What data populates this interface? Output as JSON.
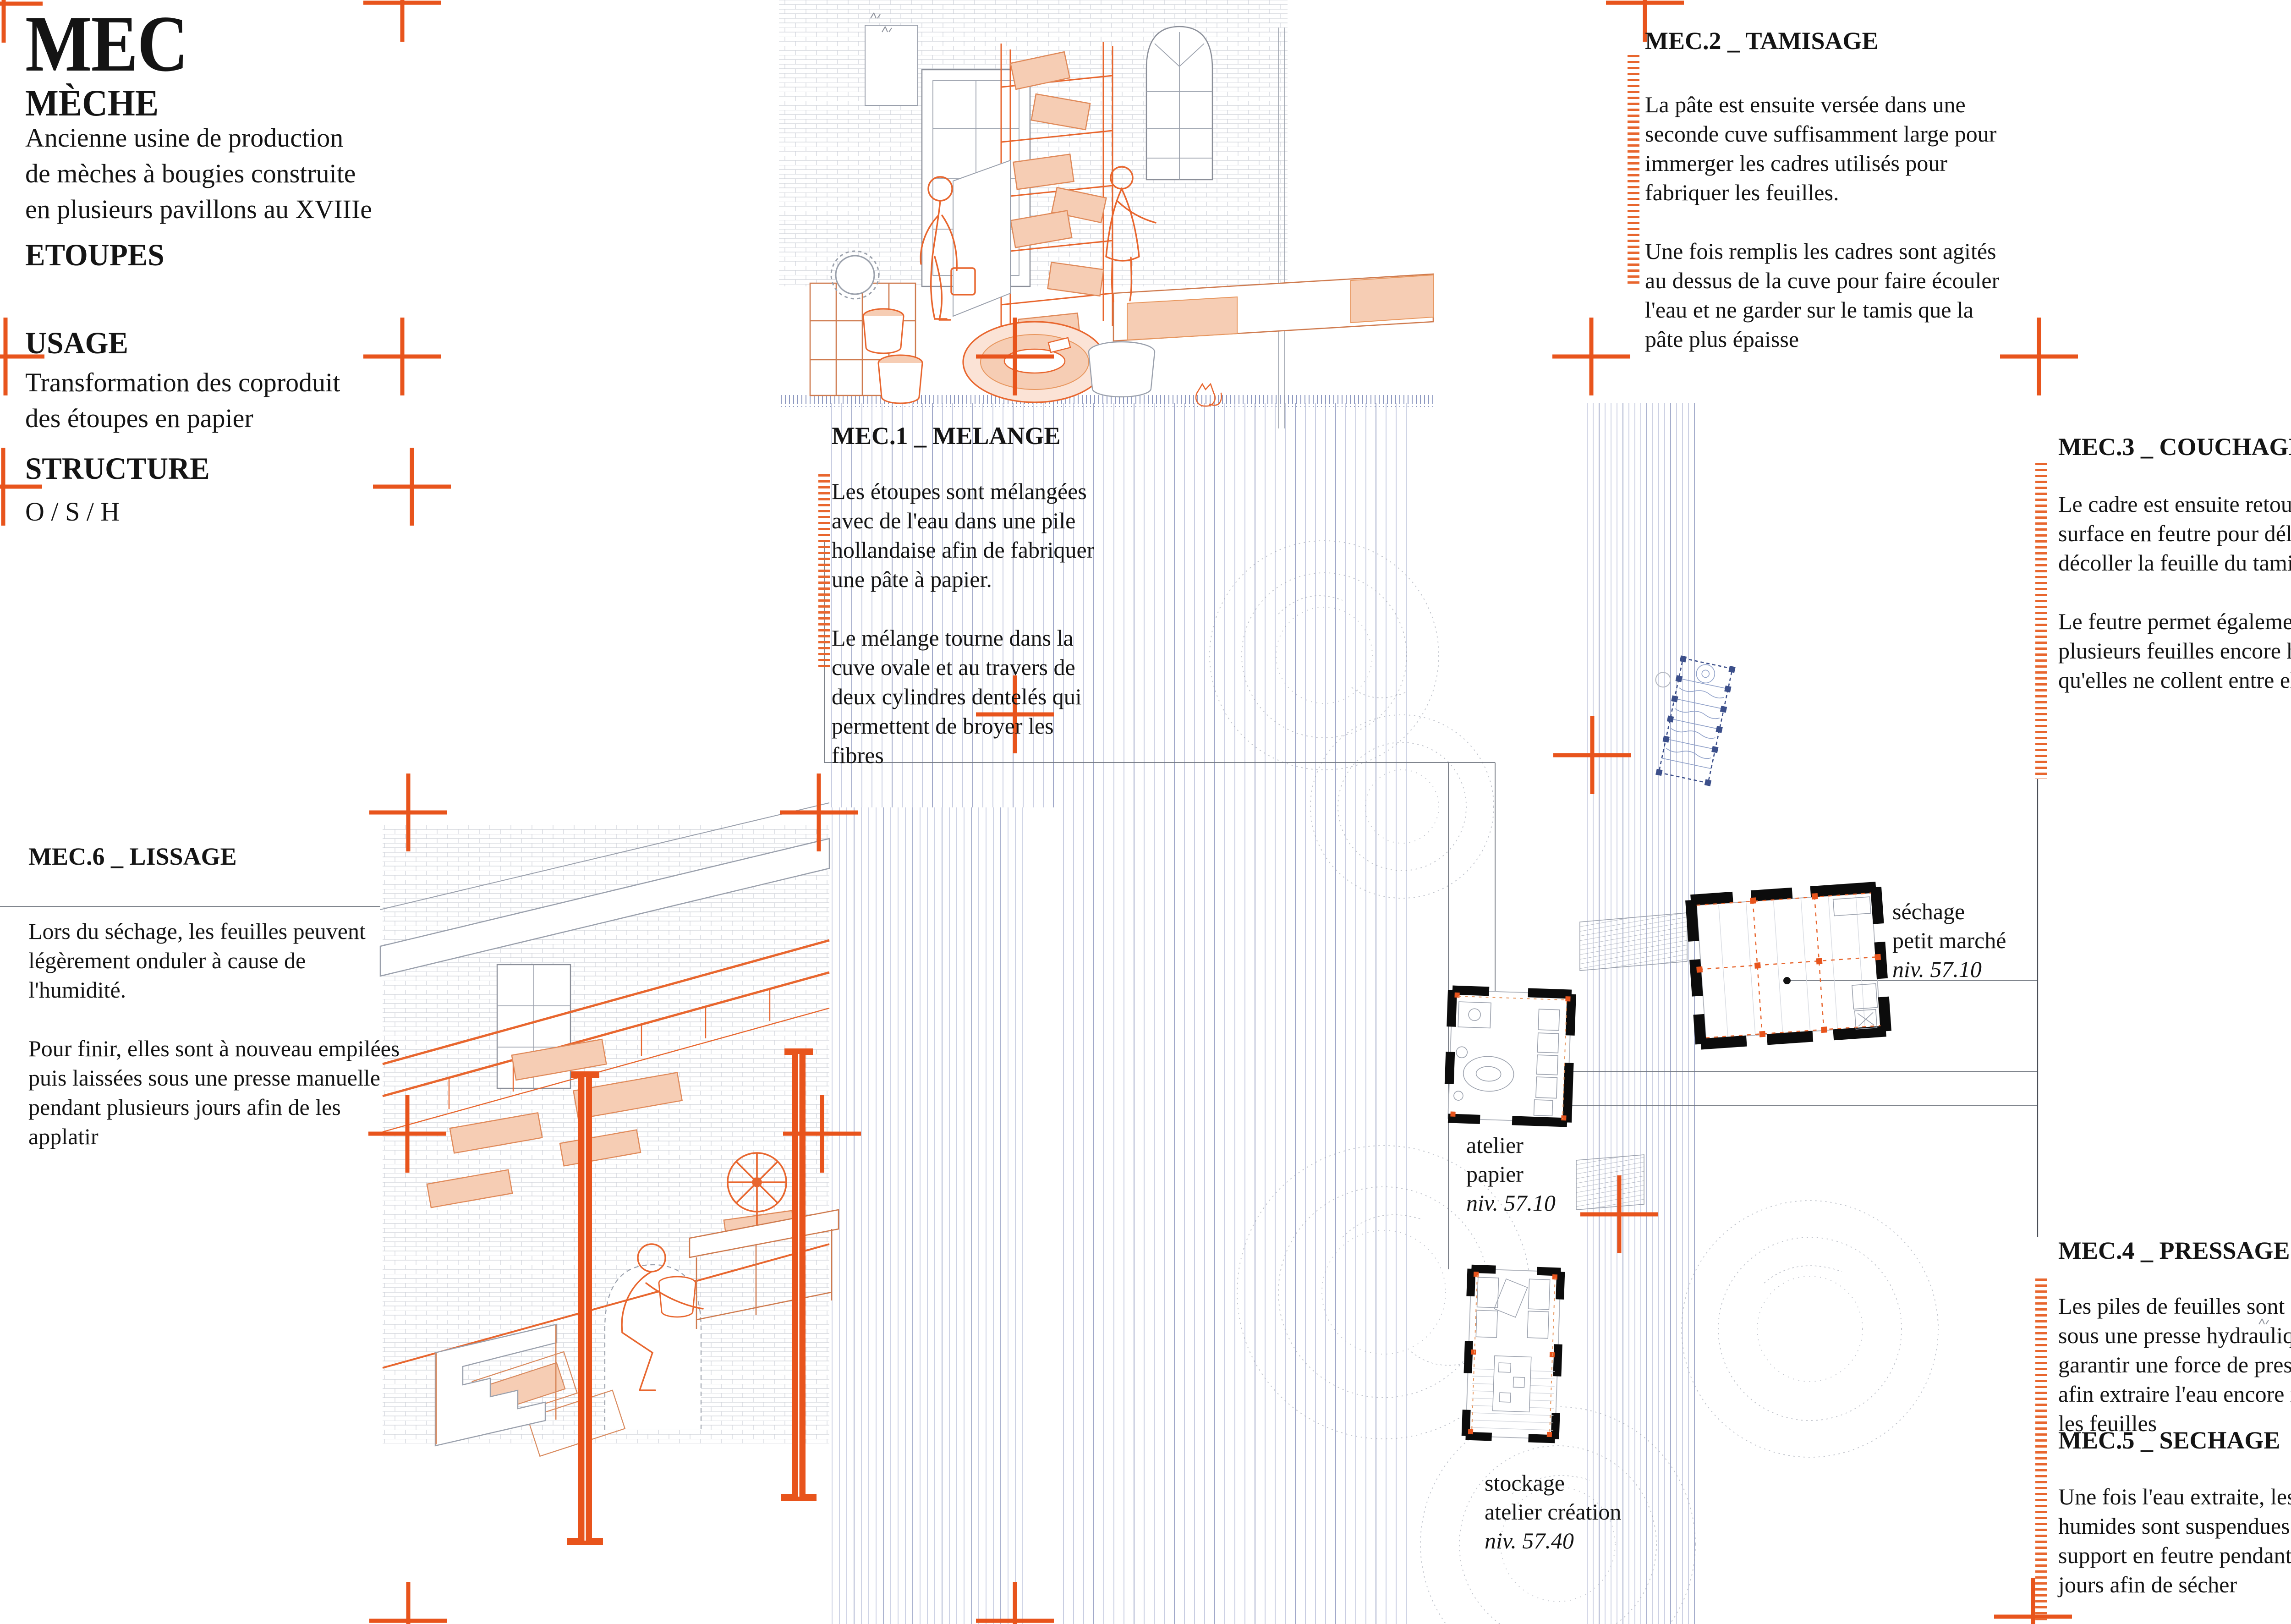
{
  "title_block": {
    "acronym": "MEC",
    "name": "MÈCHE",
    "description": "Ancienne usine de production\nde mèches à bougies construite\nen plusieurs pavillons au XVIIIe",
    "material_label": "ETOUPES",
    "usage_label": "USAGE",
    "usage_text": "Transformation des coproduit\ndes étoupes en papier",
    "structure_label": "STRUCTURE",
    "structure_value": "O / S / H"
  },
  "steps": [
    {
      "id": "MEC.1",
      "title": "MEC.1 _ MELANGE",
      "body": "Les étoupes sont mélangées\navec de l'eau dans une pile\nhollandaise afin de fabriquer\nune pâte à papier.\n\nLe mélange tourne dans la\ncuve ovale et au travers de\ndeux cylindres dentelés qui\npermettent de broyer les\nfibres"
    },
    {
      "id": "MEC.2",
      "title": "MEC.2 _ TAMISAGE",
      "body": "La pâte est ensuite versée dans une\nseconde cuve suffisamment large pour\nimmerger les cadres utilisés pour\nfabriquer les feuilles.\n\nUne fois remplis les cadres sont agités\nau dessus de la cuve pour faire écouler\nl'eau et ne garder sur le tamis que la\npâte plus épaisse"
    },
    {
      "id": "MEC.3",
      "title": "MEC.3 _ COUCHAGE",
      "body": "Le cadre est ensuite retourner sur un\nsurface en feutre pour délicatement\ndécoller la feuille du tamis.\n\nLe feutre permet également d'empiler\nplusieurs feuilles encore humides sans\nqu'elles ne collent entre elles"
    },
    {
      "id": "MEC.4",
      "title": "MEC.4 _ PRESSAGE",
      "body": "Les piles de feuilles sont ensuite mises\nsous une presse hydraulique pour\ngarantir une force de presse suffisante\nafin extraire l'eau encore imbibée dans\nles feuilles"
    },
    {
      "id": "MEC.5",
      "title": "MEC.5 _ SECHAGE",
      "body": "Une fois l'eau extraite, les feuilles\nhumides sont suspendues par leur\nsupport en feutre pendant plusieurs\njours afin de sécher"
    },
    {
      "id": "MEC.6",
      "title": "MEC.6 _ LISSAGE",
      "body": "Lors du séchage, les feuilles peuvent\nlégèrement onduler à cause de\nl'humidité.\n\nPour finir, elles sont à nouveau empilées\npuis laissées sous une presse manuelle\npendant plusieurs jours afin de les\napplatir"
    }
  ],
  "plan_labels": [
    {
      "name": "séchage\npetit marché",
      "level": "niv. 57.10"
    },
    {
      "name": "atelier\npapier",
      "level": "niv. 57.10"
    },
    {
      "name": "stockage\natelier création",
      "level": "niv. 57.40"
    }
  ],
  "colors": {
    "accent_orange": "#e8541c",
    "drawing_orange": "#e8662e",
    "paper_peach": "#f6cdb4",
    "line_gray": "#9aa0ac",
    "river_blue": "#a9b2cf",
    "schematic_blue": "#3c4f8a",
    "text_black": "#141414"
  }
}
